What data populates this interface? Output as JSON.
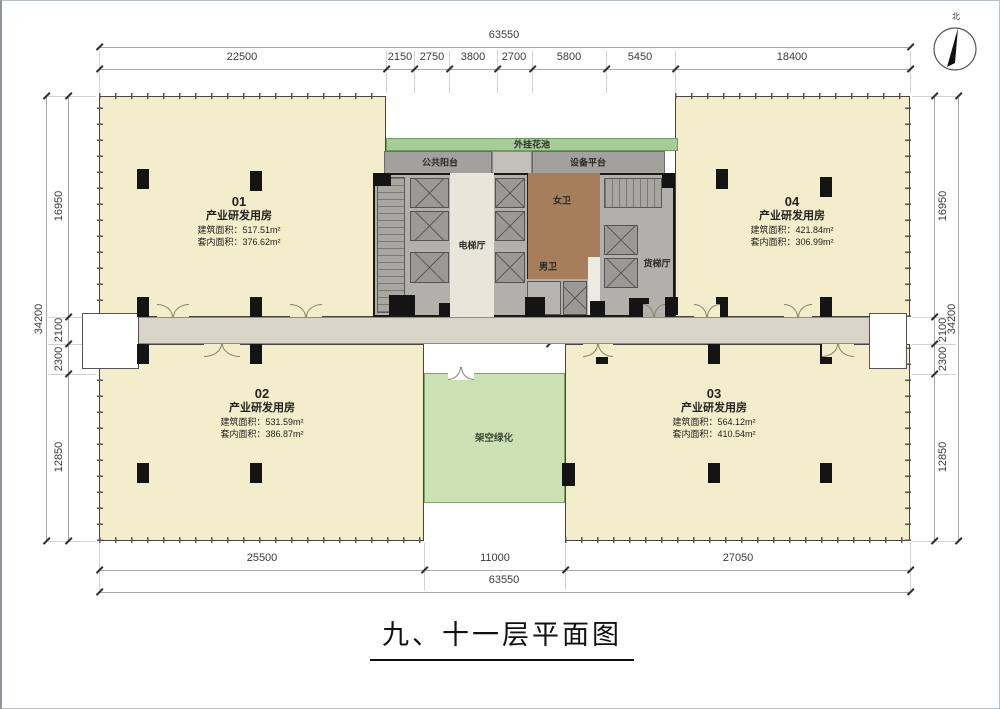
{
  "title": "九、十一层平面图",
  "compass": {
    "north": "北"
  },
  "dims": {
    "top_total": "63550",
    "top_segments": [
      "22500",
      "2150",
      "2750",
      "3800",
      "2700",
      "5800",
      "5450",
      "18400"
    ],
    "left_total": "34200",
    "left_segments": [
      "16950",
      "2100",
      "2300",
      "12850"
    ],
    "right_total": "34200",
    "right_segments": [
      "16950",
      "2100",
      "2300",
      "12850"
    ],
    "bottom_segments": [
      "25500",
      "11000",
      "27050"
    ],
    "bottom_total": "63550",
    "core_opening": "3600",
    "core_depth": "2000",
    "core_side": "1300"
  },
  "rooms": [
    {
      "num": "01",
      "type": "产业研发用房",
      "area1": "建筑面积：517.51m²",
      "area2": "套内面积：376.62m²"
    },
    {
      "num": "02",
      "type": "产业研发用房",
      "area1": "建筑面积：531.59m²",
      "area2": "套内面积：386.87m²"
    },
    {
      "num": "03",
      "type": "产业研发用房",
      "area1": "建筑面积：564.12m²",
      "area2": "套内面积：410.54m²"
    },
    {
      "num": "04",
      "type": "产业研发用房",
      "area1": "建筑面积：421.84m²",
      "area2": "套内面积：306.99m²"
    }
  ],
  "labels": {
    "flower_bed": "外挂花池",
    "public_balcony": "公共阳台",
    "equipment_platform": "设备平台",
    "elevator_hall": "电梯厅",
    "women_wc": "女卫",
    "men_wc": "男卫",
    "freight_elevator_hall": "货梯厅",
    "elevated_green": "架空绿化"
  },
  "colors": {
    "room_fill": "#f3edcb",
    "core_fill": "#b2b0ab",
    "corridor_fill": "#d9d6c9",
    "toilet_fill": "#a67e5c",
    "green_strip": "#a6cd96",
    "green_area": "#cbe3b4"
  }
}
